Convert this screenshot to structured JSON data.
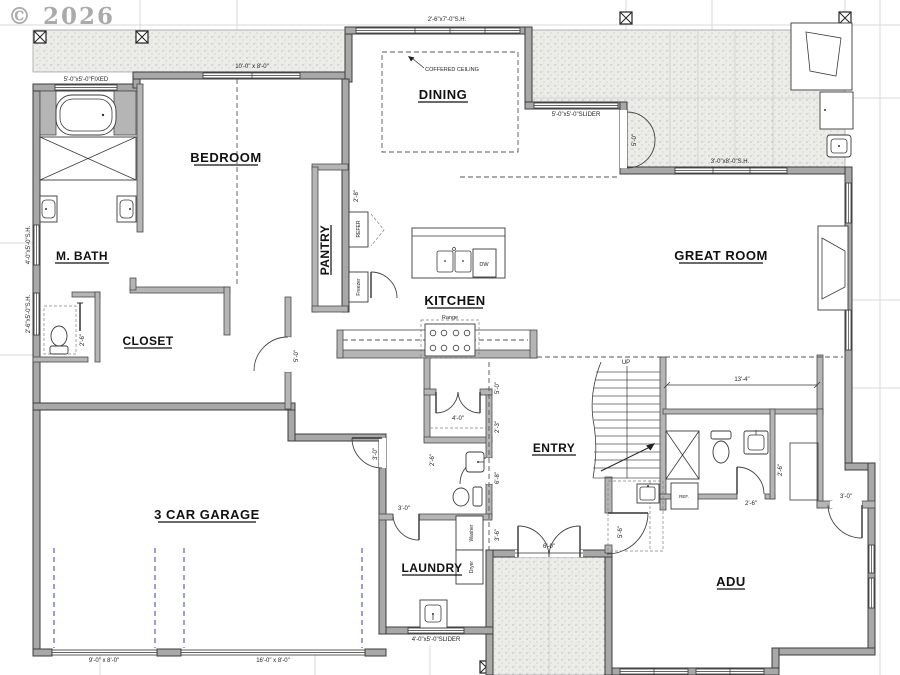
{
  "watermark": "© 2026",
  "rooms": {
    "m_bath": "M. BATH",
    "bedroom": "BEDROOM",
    "closet": "CLOSET",
    "pantry": "PANTRY",
    "dining": "DINING",
    "kitchen": "KITCHEN",
    "great_room": "GREAT ROOM",
    "garage": "3 CAR GARAGE",
    "laundry": "LAUNDRY",
    "entry": "ENTRY",
    "adu": "ADU"
  },
  "labels": {
    "coffered": "COFFERED CEILING",
    "up": "UP",
    "range": "Range",
    "refer": "REFER",
    "freezer": "Freezer",
    "washer": "Washer",
    "dryer": "Dryer",
    "dw": "DW",
    "ref": "REF."
  },
  "dims": {
    "fixed_5x5": "5'-0\"x5'-0\"FIXED",
    "win_10x8": "10'-0\" x 8'-0\"",
    "sh_2_6x7": "2'-6\"x7'-0\"S.H.",
    "slider_5x5": "5'-0\"x5'-0\"SLIDER",
    "sh_3x8": "3'-0\"x8'-0\"S.H.",
    "sh_4x5": "4'-0\"x5'-0\"S.H.",
    "sh_2_6x5": "2'-6\"x5'-0\"S.H.",
    "slider_4x5": "4'-0\"x5'-0\"SLIDER",
    "gd_9x8": "9'-0\" x 8'-0\"",
    "gd_16x8": "16'-0\" x 8'-0\"",
    "d13_4": "13'-4\"",
    "d6_0": "6'-0\"",
    "d5_0_patio": "5'-0\"",
    "d5_0_closet": "5'-0\"",
    "d5_0_entry": "5'-0\"",
    "d4_0_closet": "4'-0\"",
    "d2_3": "2'-3\"",
    "d6_8": "6'-8\"",
    "d3_6": "3'-6\"",
    "d3_0_garage": "3'-0\"",
    "d3_0_mud": "3'-0\"",
    "d3_0_adu": "3'-0\"",
    "d2_6_powder": "2'-6\"",
    "d2_6_wc": "2'-6\"",
    "d2_6_adu_door": "2'-6\"",
    "d2_6_adu_wall": "2'-6\"",
    "d2_8": "2'-8\"",
    "d5_6": "5'-6\""
  }
}
